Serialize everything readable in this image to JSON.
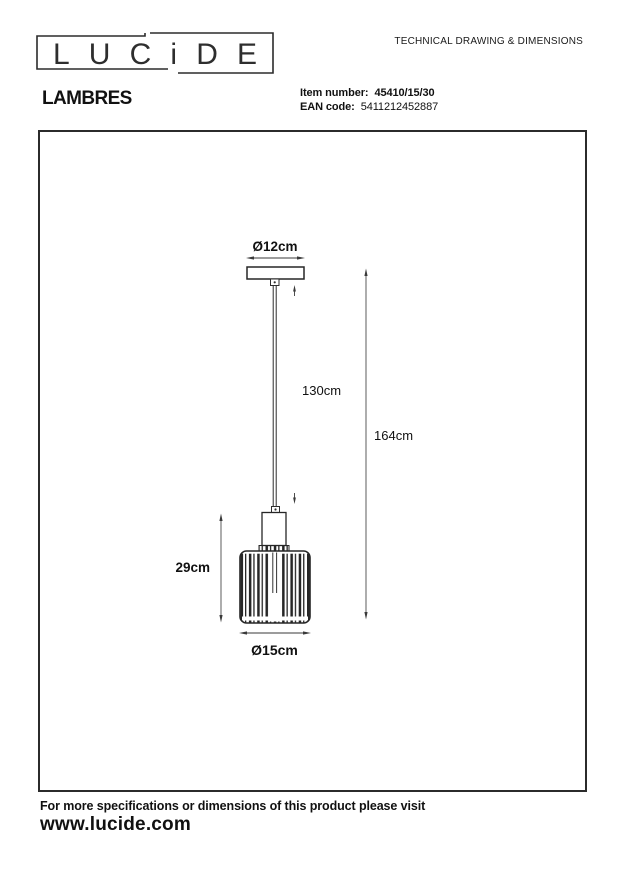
{
  "header": {
    "logo_text": "LUCiDE",
    "doc_title": "TECHNICAL DRAWING & DIMENSIONS",
    "product_name": "LAMBRES",
    "item_number_label": "Item number:",
    "item_number_value": "45410/15/30",
    "ean_label": "EAN code:",
    "ean_value": "5411212452887"
  },
  "drawing": {
    "type": "pendant-lamp-technical-drawing",
    "dimensions": {
      "canopy_diameter": "Ø12cm",
      "cord_length": "130cm",
      "total_height": "164cm",
      "shade_height": "29cm",
      "shade_diameter": "Ø15cm"
    }
  },
  "footer": {
    "note": "For more specifications or dimensions of this product please visit",
    "website": "www.lucide.com"
  },
  "colors": {
    "ink": "#1a1a1a",
    "line": "#2e2e2e",
    "thin_line": "#4a4a4a"
  }
}
